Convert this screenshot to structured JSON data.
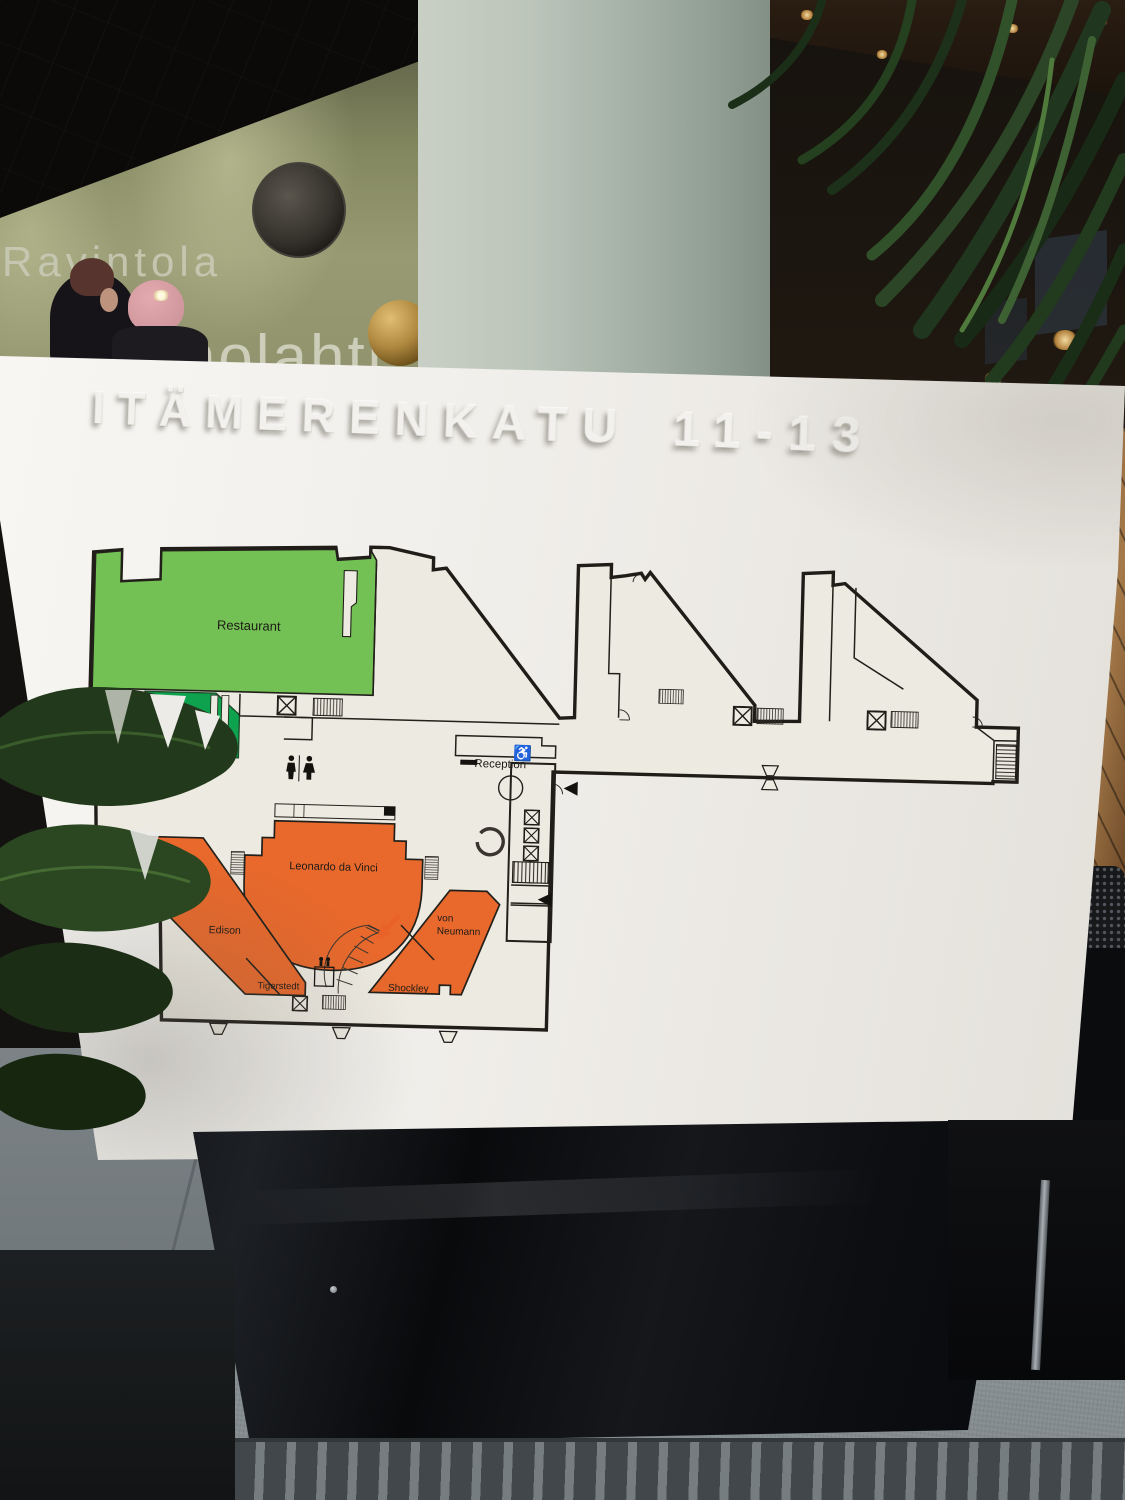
{
  "scene": {
    "wall_sign": {
      "line1": "Ravintola",
      "line2": "Ruoholahti"
    }
  },
  "sign": {
    "title": "ITÄMERENKATU 11-13",
    "plan": {
      "rooms": {
        "restaurant": "Restaurant",
        "cafeteria": "Cafeteria",
        "reception": "Reception",
        "leonardo_da_vinci": "Leonardo da Vinci",
        "edison": "Edison",
        "tigerstedt": "Tigerstedt",
        "von_neumann_line1": "von",
        "von_neumann_line2": "Neumann",
        "shockley": "Shockley"
      },
      "icons": {
        "wheelchair": "♿"
      },
      "colors": {
        "restaurant_green": "#73c154",
        "cafeteria_green": "#0fa24e",
        "meeting_room_orange": "#e9692c",
        "marker_red": "#d8232a",
        "arrow_orange": "#e8622a",
        "floor_fill": "#edeae1",
        "wall_line": "#201d19"
      }
    }
  }
}
